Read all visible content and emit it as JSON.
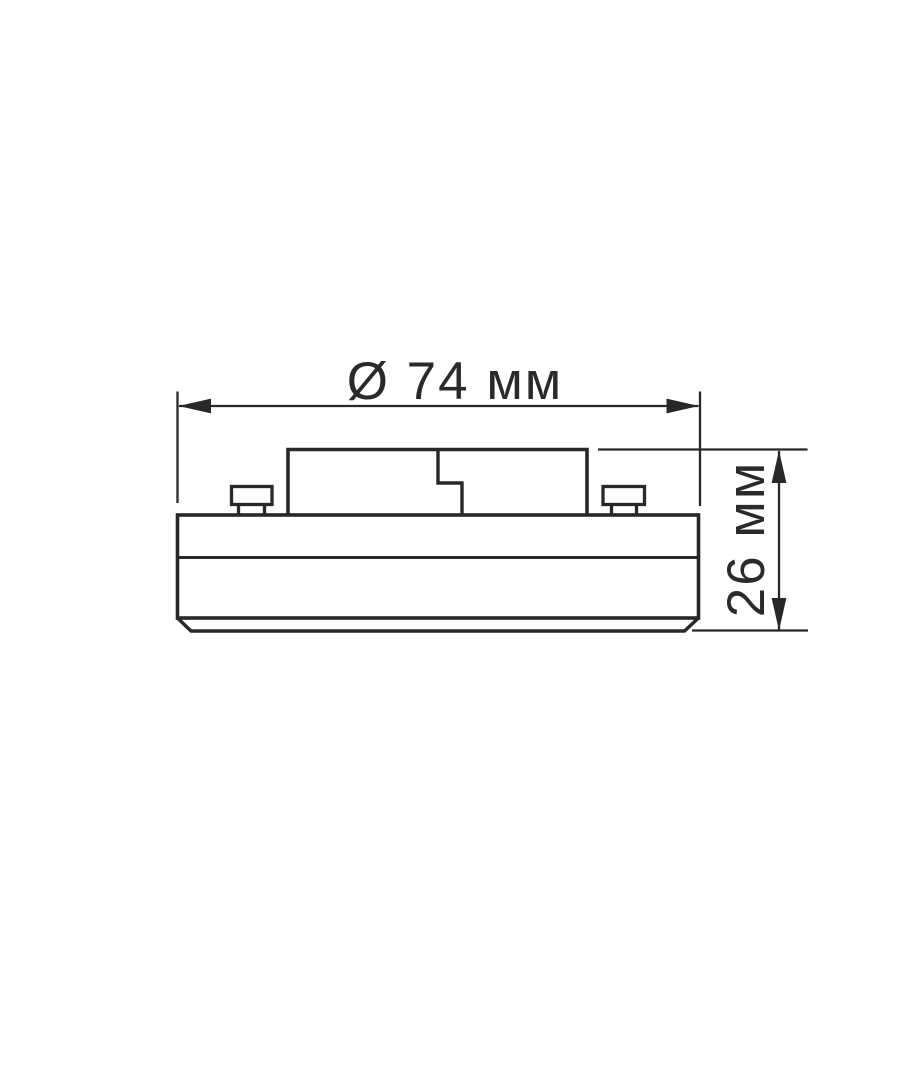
{
  "page": {
    "background_color": "#ffffff",
    "line_color": "#282828",
    "text_color": "#2a2a2a"
  },
  "diagram": {
    "kind": "technical dimension drawing",
    "subject": "puck-shaped GX53 lamp, side view with two contact pins",
    "dimensions": {
      "diameter": {
        "label": "Ø 74 мм",
        "symbol": "Ø",
        "value": 74,
        "unit": "мм",
        "orientation": "horizontal"
      },
      "height": {
        "label": "26 мм",
        "value": 26,
        "unit": "мм",
        "orientation": "vertical-rotated"
      }
    }
  }
}
